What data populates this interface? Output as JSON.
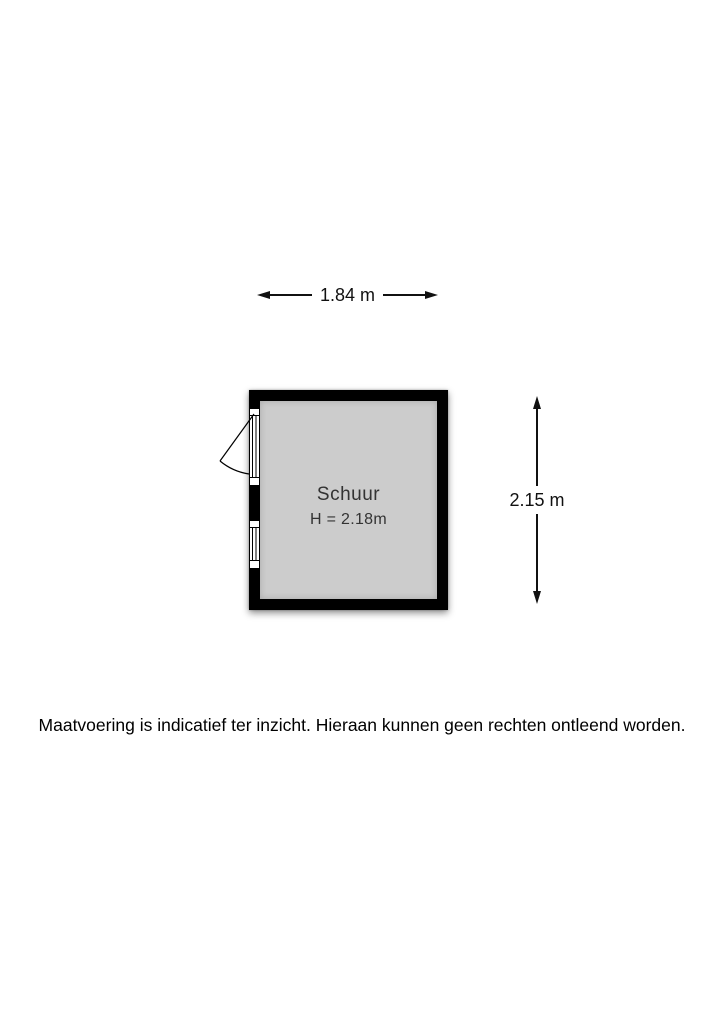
{
  "floorplan": {
    "room": {
      "name": "Schuur",
      "height_label": "H = 2.18m"
    },
    "dimensions": {
      "width_label": "1.84 m",
      "height_label": "2.15 m"
    },
    "colors": {
      "wall": "#000000",
      "floor": "#cccccc",
      "text": "#111111"
    }
  },
  "footer": {
    "disclaimer": "Maatvoering is indicatief ter inzicht. Hieraan kunnen geen rechten ontleend worden."
  }
}
